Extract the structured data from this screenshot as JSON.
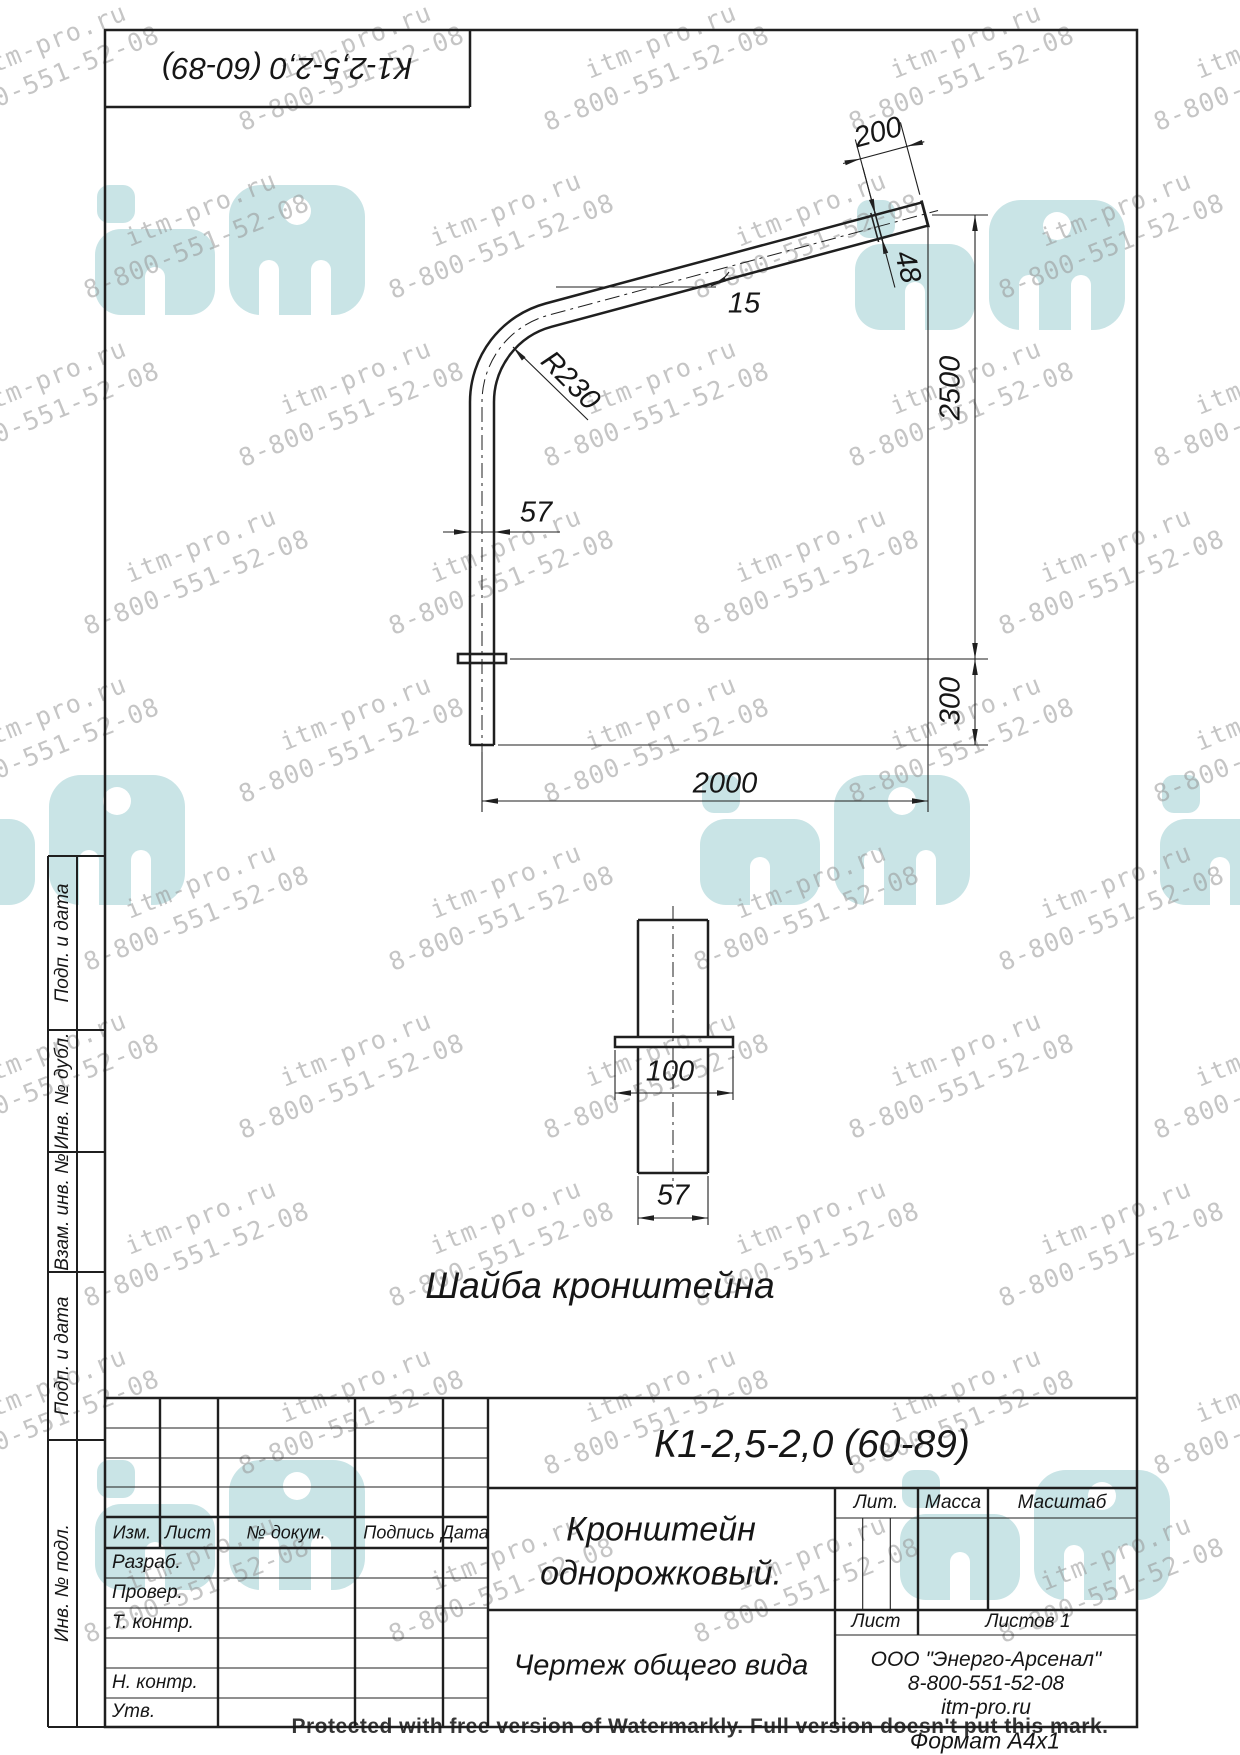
{
  "corner_stamp": {
    "designation": "К1-2,5-2,0 (60-89)"
  },
  "main_view": {
    "dims": {
      "arm_end_length": "200",
      "arm_diameter": "48",
      "angle": "15",
      "bend_radius": "R230",
      "post_diameter": "57",
      "height": "2500",
      "embed_length": "300",
      "reach": "2000"
    }
  },
  "washer_view": {
    "title": "Шайба кронштейна",
    "dims": {
      "plate_width": "100",
      "tube_diameter": "57"
    }
  },
  "side_strip": {
    "labels": [
      "Подп. и дата",
      "Инв. № дубл.",
      "Взам. инв. №",
      "Подп. и дата",
      "Инв. № подл."
    ]
  },
  "title_block": {
    "designation": "К1-2,5-2,0 (60-89)",
    "name_line1": "Кронштейн",
    "name_line2": "однорожковый.",
    "doc_type": "Чертеж общего вида",
    "lit_label": "Лит.",
    "mass_label": "Масса",
    "scale_label": "Масштаб",
    "sheet_label": "Лист",
    "sheets_label": "Листов 1",
    "company_line1": "ООО \"Энерго-Арсенал\"",
    "company_line2": "8-800-551-52-08",
    "company_line3": "itm-pro.ru",
    "header": {
      "izm": "Изм.",
      "list": "Лист",
      "doc": "№ докум.",
      "sign": "Подпись",
      "date": "Дата"
    },
    "row_razrab": "Разраб.",
    "row_prover": "Провер.",
    "row_tkontr": "Т. контр.",
    "row_nkontr": "Н. контр.",
    "row_utv": "Утв.",
    "format_label": "Формат  А4х1"
  },
  "watermark": {
    "line1": "itm-pro.ru",
    "line2": "8-800-551-52-08",
    "protected_text": "Protected with free version of Watermarkly. Full version doesn't put this mark.",
    "logo_color": "#c9e4e6"
  }
}
